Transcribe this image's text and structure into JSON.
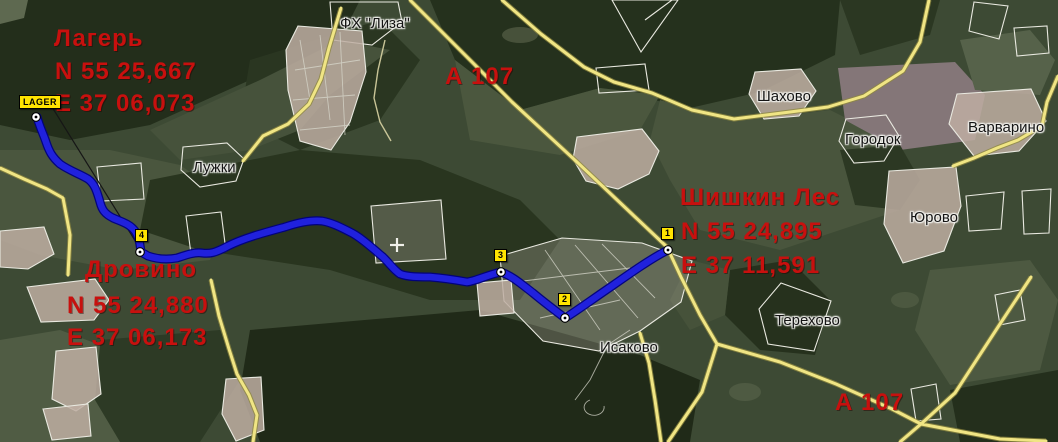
{
  "map": {
    "route_points": [
      {
        "name": "Лагерь",
        "lat": "N 55 25,667",
        "lon": "E 37 06,073"
      },
      {
        "name": "Дровино",
        "lat": "N 55 24,880",
        "lon": "E 37 06,173"
      },
      {
        "name": "Шишкин Лес",
        "lat": "N 55 24,895",
        "lon": "E 37 11,591"
      }
    ],
    "road_labels": [
      "А 107",
      "А 107"
    ],
    "place_labels": [
      "ФХ \"Лиза\"",
      "Шахово",
      "Городок",
      "Варварино",
      "Юрово",
      "Лужки",
      "Исаково",
      "Терехово"
    ],
    "waypoints": [
      {
        "label": "LAGER"
      },
      {
        "label": "4"
      },
      {
        "label": "3"
      },
      {
        "label": "2"
      },
      {
        "label": "1"
      }
    ],
    "colors": {
      "route_blue": "#2021dd",
      "route_border": "#000080",
      "road_yellow": "#f0e584",
      "label_red": "#c8100e",
      "marker_yellow": "#ffe400"
    }
  }
}
